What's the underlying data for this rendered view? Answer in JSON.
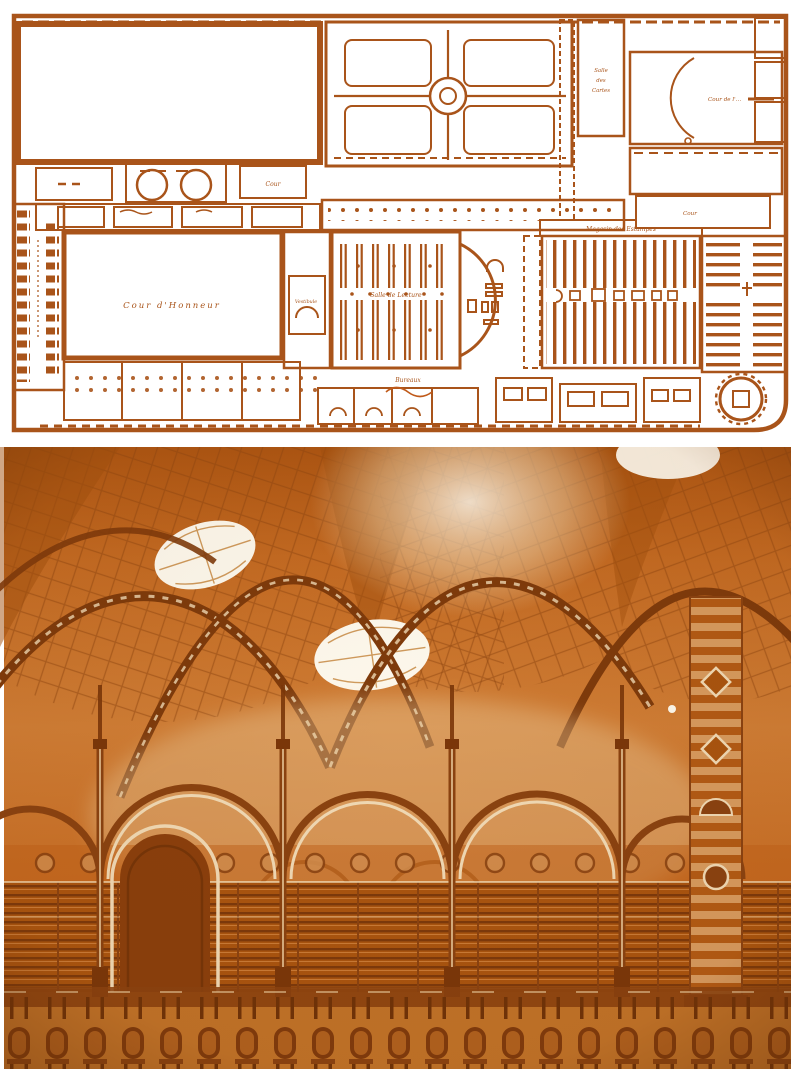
{
  "page": {
    "background": "#ffffff"
  },
  "figure": {
    "plan": {
      "ink_color": "#a9541a",
      "paper_color": "#ffffff",
      "labels": {
        "cour_honneur": "Cour d'Honneur",
        "vestibule": "Vestibule",
        "salle_lecture": "Salle de Lecture",
        "magasin_estampes": "Magasin des Estampes",
        "bureaux": "Bureaux",
        "salle_cartes_line1": "Salle",
        "salle_cartes_line2": "des",
        "salle_cartes_line3": "Cartes",
        "cour_nw": "Cour",
        "cour_ne": "Cour de l'…",
        "cour_e": "Cour"
      }
    },
    "photo": {
      "palette": {
        "highlight": "#fdf8ec",
        "cream": "#f0d9b4",
        "light_orange": "#d79a5e",
        "mid_orange": "#cf7d35",
        "deep_orange": "#b45c14",
        "dark_brown": "#8a4210",
        "shadow_brown": "#6f3208"
      }
    }
  }
}
